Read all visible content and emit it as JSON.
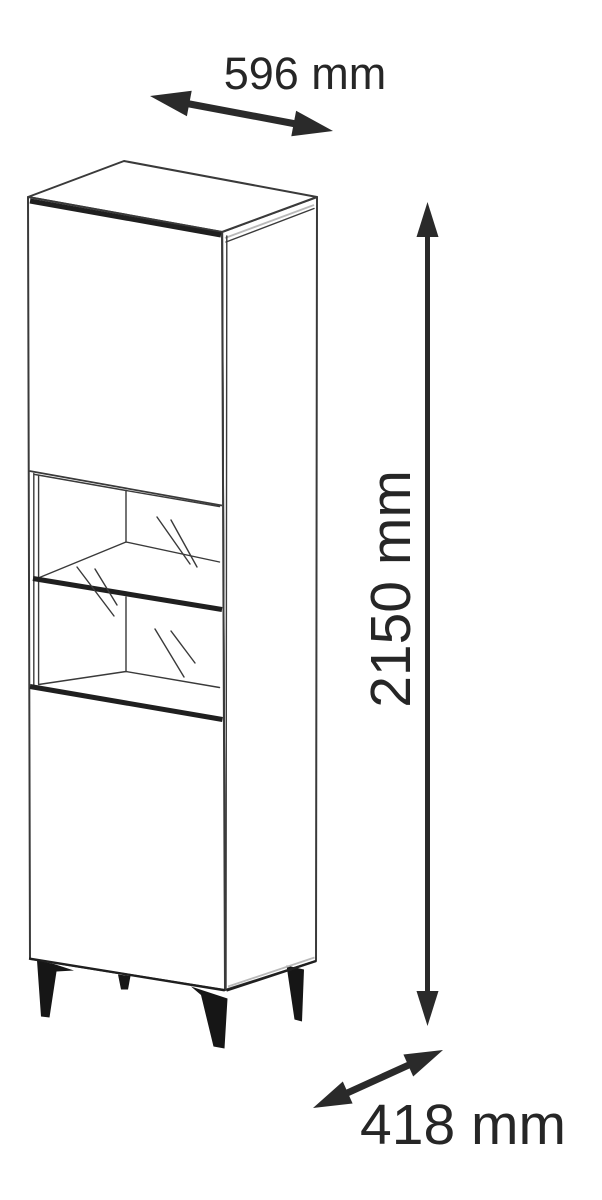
{
  "diagram": {
    "dimension_labels": {
      "width": "596 mm",
      "height": "2150 mm",
      "depth": "418 mm"
    },
    "dimensions": {
      "width_value": "596",
      "height_value": "2150",
      "depth_value": "418",
      "unit": "mm"
    },
    "colors": {
      "background": "#ffffff",
      "line": "#3a3a3a",
      "line_strong": "#1f1f1f",
      "line_light": "#b9b9b9",
      "text": "#262626",
      "arrow": "#2a2a2a",
      "leg": "#161616"
    }
  }
}
